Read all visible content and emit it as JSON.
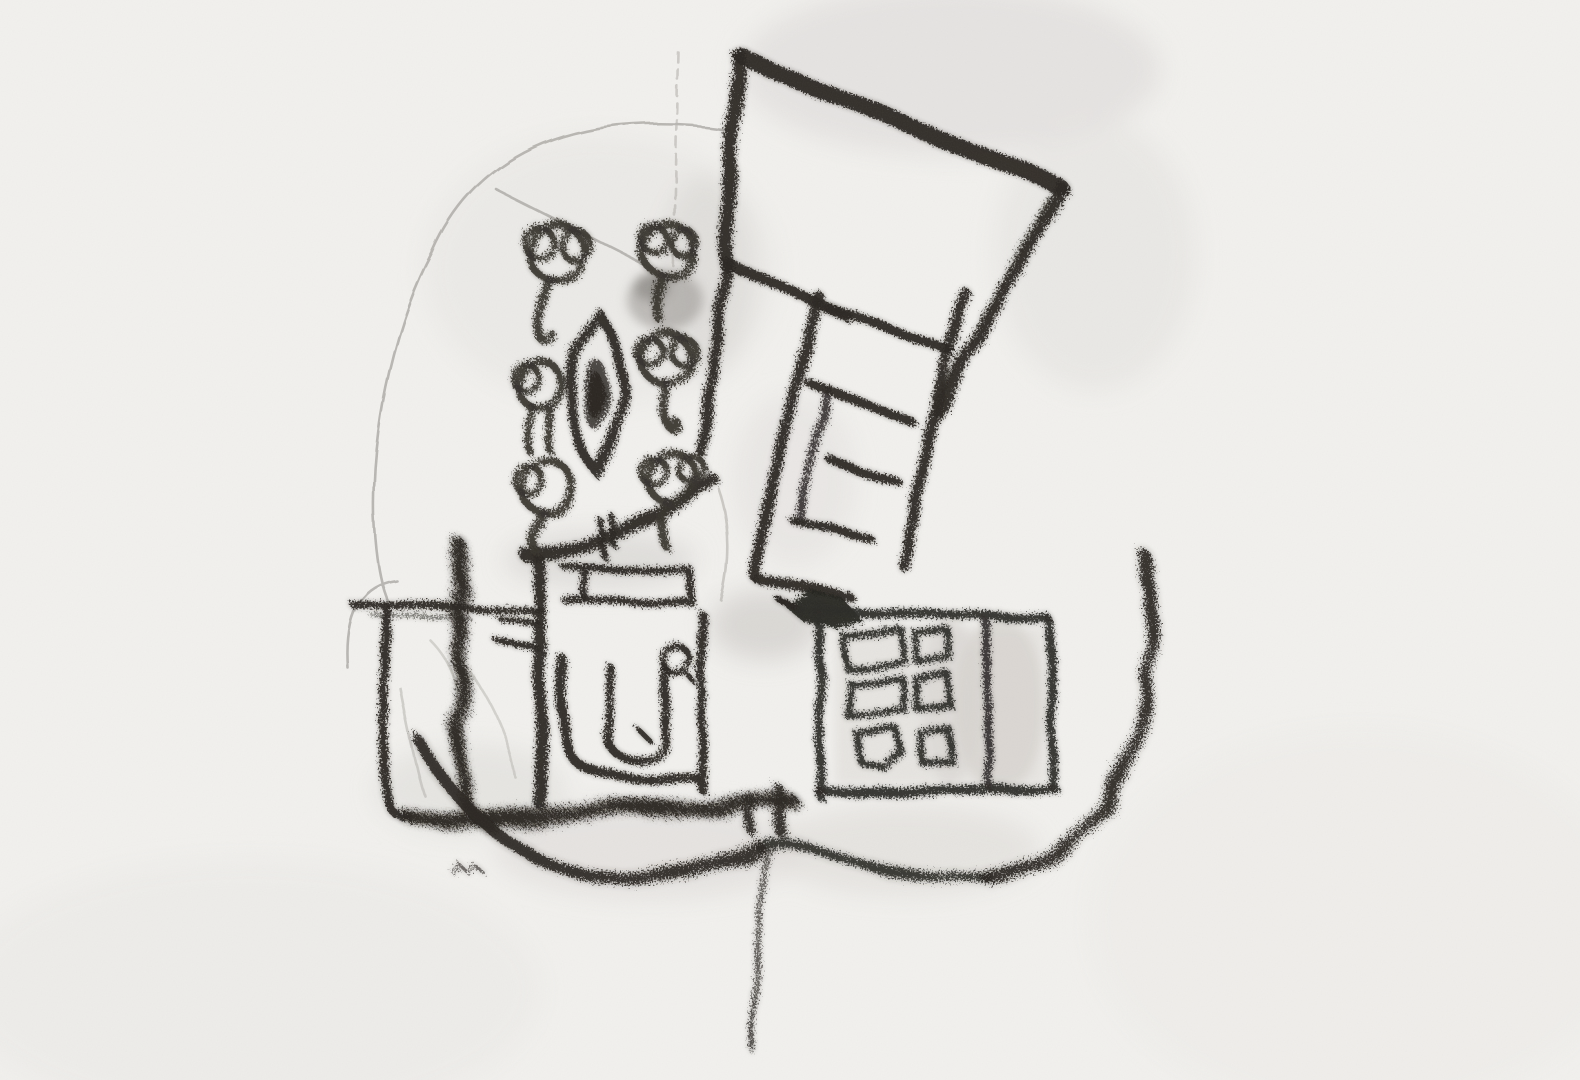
{
  "artwork": {
    "title": "Hand-drawn charcoal sketch — architectural plan study",
    "medium_note": "charcoal and soft pencil on white paper, monochrome",
    "colors": {
      "paper": "#F2F1EE",
      "charcoal": "#2B2824",
      "pencil_guides": "#B3B0AC",
      "smudge": "#D8D5D1"
    },
    "elements": [
      "tilted rectangular building outline (upper right)",
      "ladder-like stair strip with cross rungs",
      "solid arrowhead mark at stair foot",
      "six cloud-topped tree symbols (left)",
      "pointed oval lens shape with dark shaded core",
      "central block with door rectangle, quarter-curve wall, rounded U shape and small circle",
      "left open yard with fuzzy fence line",
      "right block containing 2x3 grid of small rectangles",
      "large sweeping U curve at bottom right",
      "thin vertical line descending at bottom center",
      "faint pencil construction arcs and dashed vertical guide"
    ]
  }
}
